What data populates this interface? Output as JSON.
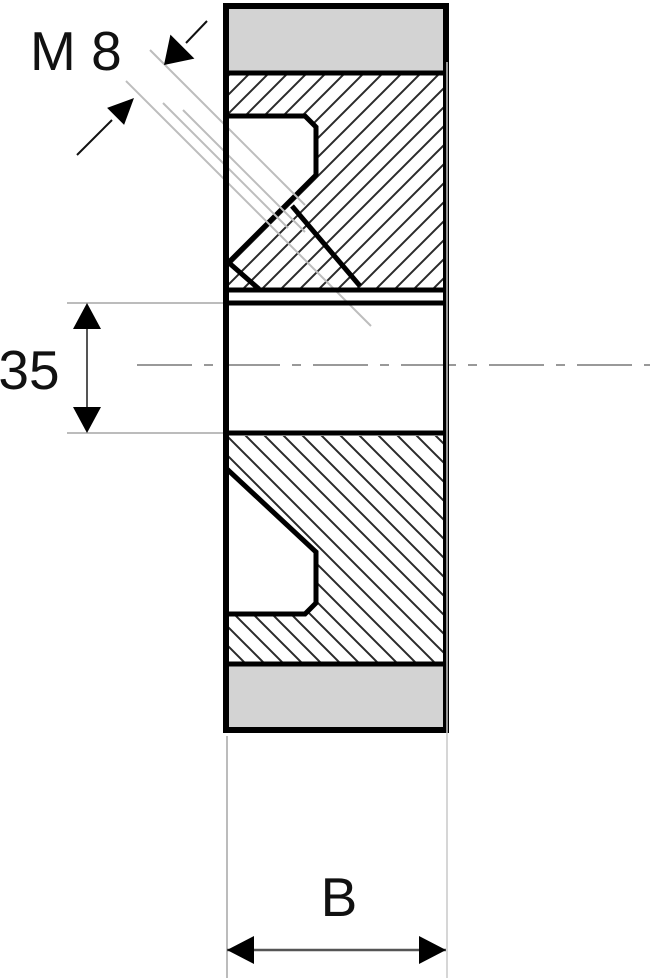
{
  "drawing": {
    "type": "technical-section-drawing",
    "labels": {
      "thread": "M 8",
      "bore_diameter": "35",
      "width": "B"
    },
    "colors": {
      "background": "#ffffff",
      "outline": "#000000",
      "face_band": "#d3d3d3",
      "hatch": "#2a2a2a",
      "thread_lines": "#bdbdbd",
      "centerline": "#999999",
      "dimension_line": "#555555",
      "extension_line": "#a5a5a5",
      "arrowhead": "#000000",
      "label_text": "#111111"
    }
  }
}
